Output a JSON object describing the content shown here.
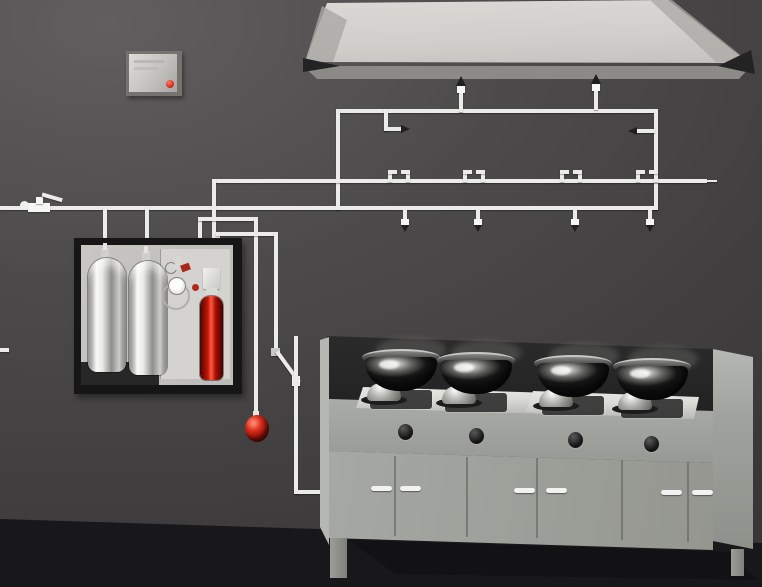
{
  "meta": {
    "description": "3D rendered illustration of a commercial kitchen automatic fire-suppression system: agent tank cabinet, control panel, overhead piping with nozzles under an exhaust hood, fusible-link detector line, and a four-wok cooking range",
    "width": 762,
    "height": 587
  },
  "colors": {
    "wall": "#4c4a4a",
    "wall_light": "#605e5e",
    "wall_dark": "#383637",
    "floor": "#18171a",
    "hood_face": "#dad9d5",
    "hood_face_dark": "#c2c1bd",
    "hood_side": "#a9a8a4",
    "hood_wedge": "#232323",
    "hood_under": "#8b8a86",
    "pipe": "#ebebe9",
    "nozzle_tip": "#1f1f1f",
    "panel_body": "#74736f",
    "panel_face": "#dcdbd7",
    "panel_face_dark": "#a7a6a2",
    "led": "#e03226",
    "cab_frame": "#161616",
    "cab_inner": "#c7c6c2",
    "cab_inner_light": "#d4d3cf",
    "cab_step": "#272727",
    "tank_hi": "#fafaf8",
    "tank_mid": "#8e8e8c",
    "red_cyl": "#c41808",
    "red_cyl_hi": "#ff5a40",
    "red_cyl_dark": "#470503",
    "sphere": "#d92c1c",
    "sphere_hi": "#ff8468",
    "sphere_dark": "#5a0808",
    "counter": "#222222",
    "range_body": "#a6a8a4",
    "range_body_dark": "#94968f",
    "range_side": "#b5b7b3",
    "range_right": "#a0a29e",
    "platform": "#dcdcd8",
    "burner_plate": "#2f2f2f",
    "chrome_hi": "#fdfdfb",
    "chrome_lo": "#5c5c58",
    "wok_hi": "#f5f5f3",
    "wok_dark": "#161616",
    "wok_shadow": "#6b6a68",
    "knob": "#141414",
    "handle": "#f2f2f0",
    "seam": "#6e706c",
    "shadow": "#121113",
    "leg": "#90928e"
  },
  "scene": {
    "control_panel": {
      "led_count": 1
    },
    "suppression_cabinet": {
      "agent_tank_count": 2,
      "actuation_cartridge_count": 1,
      "pressure_gauge_count": 2
    },
    "release_ball_count": 1,
    "piping": {
      "duct_nozzles": [
        {
          "left": 454,
          "top": 76
        },
        {
          "left": 589,
          "top": 74
        }
      ],
      "plenum_nozzle_count": 2,
      "appliance_nozzles": [
        {
          "left": 401,
          "top": 210
        },
        {
          "left": 474,
          "top": 210
        },
        {
          "left": 571,
          "top": 210
        },
        {
          "left": 646,
          "top": 210
        }
      ],
      "fusible_link_detectors": [
        {
          "left": 388,
          "top": 170
        },
        {
          "left": 463,
          "top": 170
        },
        {
          "left": 560,
          "top": 170
        },
        {
          "left": 636,
          "top": 170
        }
      ]
    },
    "range": {
      "wok_count": 4,
      "wok_shadows": [
        {
          "left": 376,
          "top": 337
        },
        {
          "left": 451,
          "top": 340
        },
        {
          "left": 549,
          "top": 343
        },
        {
          "left": 628,
          "top": 346
        }
      ],
      "burner_plates": [
        {
          "left": 370,
          "top": 390
        },
        {
          "left": 445,
          "top": 393
        },
        {
          "left": 542,
          "top": 396
        },
        {
          "left": 621,
          "top": 399
        }
      ],
      "burner_bases": [
        {
          "left": 361,
          "top": 383
        },
        {
          "left": 436,
          "top": 386
        },
        {
          "left": 533,
          "top": 389
        },
        {
          "left": 612,
          "top": 392
        }
      ],
      "woks": [
        {
          "left": 362,
          "top": 349
        },
        {
          "left": 437,
          "top": 352
        },
        {
          "left": 534,
          "top": 355
        },
        {
          "left": 613,
          "top": 358
        }
      ],
      "knobs": [
        {
          "left": 398,
          "top": 424
        },
        {
          "left": 469,
          "top": 428
        },
        {
          "left": 568,
          "top": 432
        },
        {
          "left": 644,
          "top": 436
        }
      ],
      "door_seams": [
        {
          "left": 394,
          "top": 456
        },
        {
          "left": 466,
          "top": 457
        },
        {
          "left": 536,
          "top": 458
        },
        {
          "left": 621,
          "top": 460
        },
        {
          "left": 687,
          "top": 462
        }
      ],
      "door_handles": [
        {
          "left": 371,
          "top": 486
        },
        {
          "left": 400,
          "top": 486
        },
        {
          "left": 514,
          "top": 488
        },
        {
          "left": 546,
          "top": 488
        },
        {
          "left": 661,
          "top": 490
        },
        {
          "left": 692,
          "top": 490
        }
      ]
    }
  }
}
